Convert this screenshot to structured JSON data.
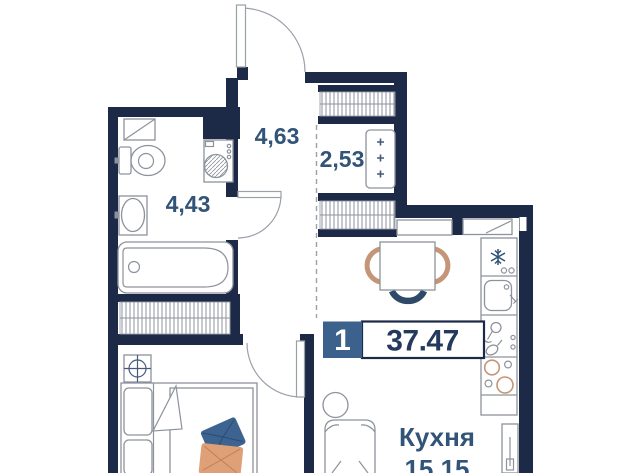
{
  "floor_plan": {
    "badge": {
      "room_count": "1",
      "total_area": "37.47"
    },
    "rooms": {
      "hallway": {
        "area": "4,63"
      },
      "bathroom": {
        "area": "4,43"
      },
      "closet": {
        "area": "2,53"
      },
      "kitchen_living": {
        "name": "Кухня",
        "area": "15.15"
      }
    },
    "colors": {
      "wall": "#1c2a47",
      "room_label": "#315478",
      "badge_square": "#3b618c",
      "badge_number": "#233a5e",
      "furniture_outline": "#8d939c",
      "chair_tan": "#c59579",
      "chair_navy": "#2e4a68",
      "pillow_blue": "#3d6391",
      "pillow_orange": "#dfa077"
    },
    "icons": {
      "fridge": "snowflake-icon",
      "bar_cabinet": "wine-glasses-icon",
      "radiator": "crosshair-circle-icon",
      "closet_panel": "plus-marks-icon"
    }
  }
}
